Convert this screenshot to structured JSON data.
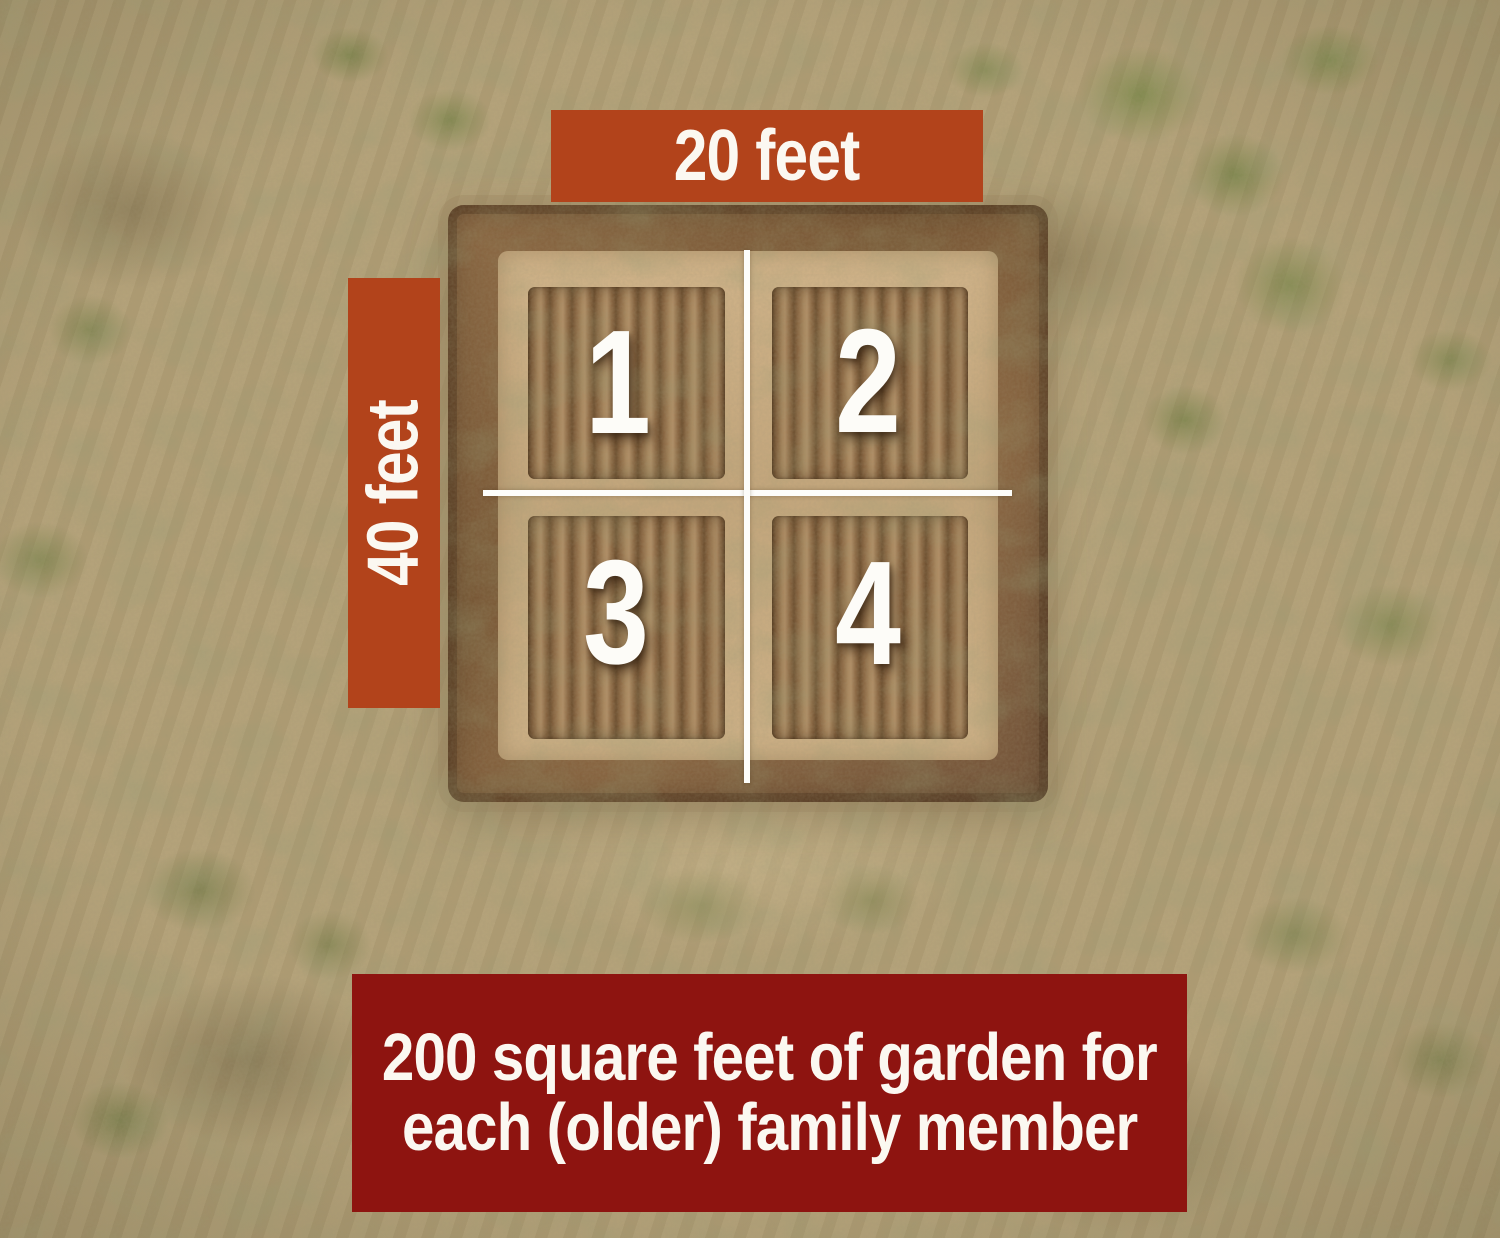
{
  "scene": {
    "description": "Aerial drone photo of a square tilled garden plot in a dry grassy field, divided into four numbered quadrants by white cross lines"
  },
  "dimension_labels": {
    "top": "20 feet",
    "left": "40 feet"
  },
  "quadrant_numbers": [
    "1",
    "2",
    "3",
    "4"
  ],
  "caption": {
    "line1": "200 square feet of garden for",
    "line2": "each (older) family member"
  },
  "colors": {
    "dimension_label_background": "#b2431b",
    "caption_background": "#8e1410",
    "overlay_text": "#fbf8f1",
    "divider_lines": "#fdfdfa",
    "field_base": "#b2a078",
    "tilled_soil": "#8a6743"
  }
}
